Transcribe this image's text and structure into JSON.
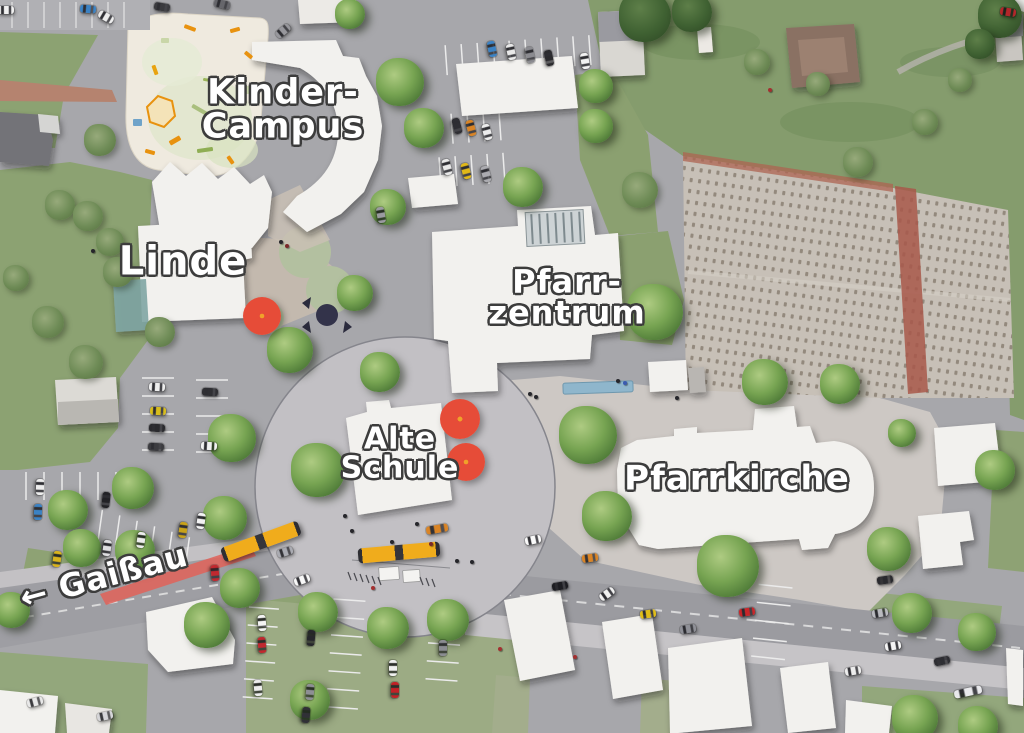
{
  "scene": {
    "type": "aerial-site-plan-photomontage",
    "description": "Village centre masterplan aerial rendering with labeled buildings",
    "width": 1024,
    "height": 733
  },
  "labels": [
    {
      "id": "kinder-campus",
      "text": "Kinder-\nCampus"
    },
    {
      "id": "linde",
      "text": "Linde"
    },
    {
      "id": "pfarrzentrum",
      "text": "Pfarr-\nzentrum"
    },
    {
      "id": "alte-schule",
      "text": "Alte\nSchule"
    },
    {
      "id": "pfarrkirche",
      "text": "Pfarrkirche"
    },
    {
      "id": "gaissau",
      "text": "← Gaißau"
    }
  ],
  "palette": {
    "road": "#a7a7ab",
    "plaza": "#cdc8c4",
    "circle_plaza": "#c2c0c4",
    "lawn": "#8ca272",
    "building_white": "#f2f1ee",
    "tree_green": "#77a452",
    "tree_marker_red": "#e64c38",
    "bus_yellow": "#f0ac1c",
    "cemetery": "#c7c0b7",
    "cemetery_wall": "#a8584a",
    "red_road_marking": "#e06159",
    "water": "#8fb6cc"
  },
  "map": {
    "trees": [
      [
        350,
        14,
        30,
        "g"
      ],
      [
        400,
        82,
        48,
        "g"
      ],
      [
        424,
        128,
        40,
        "g"
      ],
      [
        523,
        187,
        40,
        "g"
      ],
      [
        388,
        207,
        36,
        "g"
      ],
      [
        596,
        86,
        34,
        "g"
      ],
      [
        596,
        126,
        34,
        "g"
      ],
      [
        645,
        16,
        52,
        "d"
      ],
      [
        692,
        12,
        40,
        "d"
      ],
      [
        1000,
        16,
        44,
        "d"
      ],
      [
        980,
        44,
        30,
        "d"
      ],
      [
        100,
        140,
        32,
        "b"
      ],
      [
        60,
        205,
        30,
        "b"
      ],
      [
        88,
        216,
        30,
        "b"
      ],
      [
        110,
        242,
        28,
        "b"
      ],
      [
        16,
        278,
        26,
        "b"
      ],
      [
        118,
        272,
        30,
        "b"
      ],
      [
        48,
        322,
        32,
        "b"
      ],
      [
        86,
        362,
        34,
        "b"
      ],
      [
        160,
        332,
        30,
        "b"
      ],
      [
        355,
        293,
        36,
        "g"
      ],
      [
        290,
        350,
        46,
        "g"
      ],
      [
        380,
        372,
        40,
        "g"
      ],
      [
        318,
        470,
        54,
        "g"
      ],
      [
        232,
        438,
        48,
        "g"
      ],
      [
        133,
        488,
        42,
        "g"
      ],
      [
        68,
        510,
        40,
        "g"
      ],
      [
        82,
        548,
        38,
        "g"
      ],
      [
        135,
        550,
        40,
        "g"
      ],
      [
        225,
        518,
        44,
        "g"
      ],
      [
        240,
        588,
        40,
        "g"
      ],
      [
        12,
        610,
        36,
        "g"
      ],
      [
        207,
        625,
        46,
        "g"
      ],
      [
        318,
        612,
        40,
        "g"
      ],
      [
        388,
        628,
        42,
        "g"
      ],
      [
        448,
        620,
        42,
        "g"
      ],
      [
        310,
        700,
        40,
        "g"
      ],
      [
        655,
        312,
        56,
        "g"
      ],
      [
        588,
        435,
        58,
        "g"
      ],
      [
        607,
        516,
        50,
        "g"
      ],
      [
        728,
        566,
        62,
        "g"
      ],
      [
        889,
        549,
        44,
        "g"
      ],
      [
        765,
        382,
        46,
        "g"
      ],
      [
        840,
        384,
        40,
        "g"
      ],
      [
        912,
        613,
        40,
        "g"
      ],
      [
        977,
        632,
        38,
        "g"
      ],
      [
        915,
        718,
        46,
        "g"
      ],
      [
        978,
        726,
        40,
        "g"
      ],
      [
        902,
        433,
        28,
        "g"
      ],
      [
        995,
        470,
        40,
        "g"
      ],
      [
        757,
        62,
        26,
        "b"
      ],
      [
        818,
        84,
        24,
        "b"
      ],
      [
        858,
        162,
        30,
        "b"
      ],
      [
        925,
        122,
        26,
        "b"
      ],
      [
        960,
        80,
        24,
        "b"
      ],
      [
        640,
        190,
        36,
        "b"
      ]
    ],
    "cars": [
      [
        6,
        10,
        0,
        "#f0f0f0"
      ],
      [
        88,
        9,
        5,
        "#3b82c4"
      ],
      [
        106,
        17,
        30,
        "#ededed"
      ],
      [
        162,
        7,
        10,
        "#3a3a3e"
      ],
      [
        222,
        4,
        15,
        "#66666b"
      ],
      [
        283,
        31,
        -40,
        "#97979c"
      ],
      [
        381,
        215,
        80,
        "#9a9aa0"
      ],
      [
        492,
        49,
        78,
        "#3b82c4"
      ],
      [
        511,
        52,
        78,
        "#e8e8e8"
      ],
      [
        530,
        55,
        78,
        "#8b8b90"
      ],
      [
        549,
        58,
        78,
        "#2b2b2e"
      ],
      [
        585,
        61,
        80,
        "#f2f2f2"
      ],
      [
        457,
        126,
        75,
        "#2e2e33"
      ],
      [
        471,
        128,
        75,
        "#d98426"
      ],
      [
        487,
        132,
        75,
        "#ececec"
      ],
      [
        447,
        167,
        75,
        "#e8e8e8"
      ],
      [
        466,
        171,
        75,
        "#e0b818"
      ],
      [
        486,
        174,
        75,
        "#ababb0"
      ],
      [
        157,
        387,
        3,
        "#ededed"
      ],
      [
        158,
        411,
        3,
        "#d8bd1c"
      ],
      [
        157,
        428,
        3,
        "#2a2a2e"
      ],
      [
        156,
        447,
        3,
        "#3c3c40"
      ],
      [
        210,
        392,
        3,
        "#2f2f33"
      ],
      [
        209,
        446,
        3,
        "#f1f1f1"
      ],
      [
        40,
        487,
        92,
        "#ededed"
      ],
      [
        38,
        512,
        92,
        "#3b82c4"
      ],
      [
        106,
        500,
        96,
        "#222226"
      ],
      [
        201,
        521,
        98,
        "#f2f2f2"
      ],
      [
        183,
        530,
        98,
        "#c8a219"
      ],
      [
        141,
        540,
        98,
        "#ececec"
      ],
      [
        107,
        548,
        98,
        "#dedee0"
      ],
      [
        57,
        559,
        98,
        "#d8b31c"
      ],
      [
        215,
        573,
        85,
        "#c0282f"
      ],
      [
        302,
        580,
        -20,
        "#f8f8f8"
      ],
      [
        285,
        552,
        -18,
        "#aaabb2"
      ],
      [
        437,
        529,
        -10,
        "#d98426",
        22
      ],
      [
        533,
        540,
        -12,
        "#fafafa"
      ],
      [
        590,
        558,
        -8,
        "#d98426"
      ],
      [
        560,
        586,
        -10,
        "#1d1d22"
      ],
      [
        607,
        594,
        -35,
        "#f0f0f0"
      ],
      [
        648,
        614,
        -8,
        "#e0bd18"
      ],
      [
        688,
        629,
        -10,
        "#8f9097"
      ],
      [
        747,
        612,
        -8,
        "#c8262a"
      ],
      [
        885,
        580,
        -8,
        "#2a2a2e"
      ],
      [
        880,
        613,
        -10,
        "#b9babf"
      ],
      [
        893,
        646,
        -10,
        "#f4f4f4"
      ],
      [
        942,
        661,
        -12,
        "#2e2e33"
      ],
      [
        853,
        671,
        -10,
        "#ededed"
      ],
      [
        968,
        692,
        -12,
        "#e9e9ec",
        28
      ],
      [
        262,
        623,
        85,
        "#f4f4f4"
      ],
      [
        262,
        645,
        85,
        "#c0282f"
      ],
      [
        258,
        688,
        85,
        "#ededed"
      ],
      [
        311,
        638,
        95,
        "#26262b"
      ],
      [
        310,
        692,
        95,
        "#8e8f95"
      ],
      [
        306,
        715,
        95,
        "#303036"
      ],
      [
        393,
        668,
        90,
        "#f0f0f0"
      ],
      [
        395,
        690,
        90,
        "#c22126"
      ],
      [
        443,
        648,
        90,
        "#8b8c92"
      ],
      [
        35,
        702,
        -15,
        "#e8e8e8"
      ],
      [
        105,
        716,
        -12,
        "#d5d5d8"
      ],
      [
        1008,
        12,
        10,
        "#b3262a"
      ]
    ],
    "buses": [
      [
        261,
        541,
        -20
      ],
      [
        399,
        552,
        -5
      ]
    ],
    "tree_markers": [
      [
        262,
        316,
        38
      ],
      [
        460,
        419,
        40
      ],
      [
        466,
        462,
        38
      ]
    ],
    "people": [
      [
        281,
        242,
        "#26262b"
      ],
      [
        287,
        246,
        "#7a2a2a"
      ],
      [
        345,
        516,
        "#26262b"
      ],
      [
        352,
        531,
        "#26262b"
      ],
      [
        392,
        542,
        "#26262b"
      ],
      [
        417,
        524,
        "#26262b"
      ],
      [
        431,
        544,
        "#7a2a2a"
      ],
      [
        457,
        561,
        "#26262b"
      ],
      [
        472,
        562,
        "#26262b"
      ],
      [
        530,
        394,
        "#26262b"
      ],
      [
        536,
        397,
        "#26262b"
      ],
      [
        93,
        251,
        "#26262b"
      ],
      [
        618,
        381,
        "#26262b"
      ],
      [
        625,
        383,
        "#3b5bb0"
      ],
      [
        677,
        398,
        "#26262b"
      ],
      [
        373,
        588,
        "#a33030"
      ],
      [
        500,
        649,
        "#a33030"
      ],
      [
        575,
        657,
        "#a33030"
      ],
      [
        770,
        90,
        "#a33030"
      ]
    ],
    "playground_marks": [
      {
        "x": 190,
        "y": 28,
        "w": 12,
        "h": 4,
        "c": "#e8920f",
        "r": 20
      },
      {
        "x": 235,
        "y": 30,
        "w": 10,
        "h": 4,
        "c": "#e8920f",
        "r": -15
      },
      {
        "x": 248,
        "y": 55,
        "w": 9,
        "h": 4,
        "c": "#e8920f",
        "r": 40
      },
      {
        "x": 155,
        "y": 70,
        "w": 10,
        "h": 4,
        "c": "#e8a30f",
        "r": 70
      },
      {
        "x": 210,
        "y": 80,
        "w": 14,
        "h": 3,
        "c": "#9bb55a",
        "r": 10
      },
      {
        "x": 175,
        "y": 140,
        "w": 12,
        "h": 5,
        "c": "#e8920f",
        "r": -30
      },
      {
        "x": 150,
        "y": 152,
        "w": 10,
        "h": 4,
        "c": "#e8920f",
        "r": 15
      },
      {
        "x": 205,
        "y": 150,
        "w": 16,
        "h": 4,
        "c": "#8fae54",
        "r": -8
      },
      {
        "x": 240,
        "y": 120,
        "w": 10,
        "h": 8,
        "c": "#b9cf90",
        "r": 0
      },
      {
        "x": 137,
        "y": 122,
        "w": 9,
        "h": 7,
        "c": "#6fa3c9",
        "r": 0
      },
      {
        "x": 230,
        "y": 160,
        "w": 9,
        "h": 4,
        "c": "#e8920f",
        "r": 55
      },
      {
        "x": 250,
        "y": 90,
        "w": 8,
        "h": 8,
        "c": "#cdd9ae",
        "r": 0
      },
      {
        "x": 165,
        "y": 40,
        "w": 8,
        "h": 5,
        "c": "#c9d6a8",
        "r": 0
      },
      {
        "x": 200,
        "y": 110,
        "w": 18,
        "h": 4,
        "c": "#a9bf7d",
        "r": 30
      }
    ]
  }
}
